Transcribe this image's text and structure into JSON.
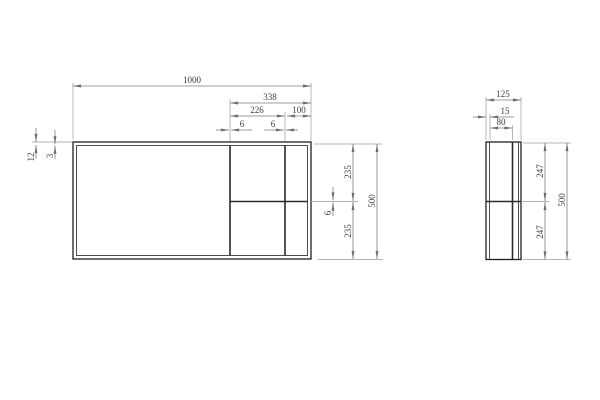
{
  "drawing": {
    "type": "technical-dimension-drawing",
    "views": {
      "front_view": "front elevation",
      "side_view": "side section"
    }
  },
  "dims": {
    "front": {
      "overall_width": "1000",
      "bay_width": "338",
      "bay_inner_width": "226",
      "right_bay_width": "100",
      "divider1_thickness": "6",
      "divider2_thickness": "6",
      "top_wall": "12",
      "top_wall_inner": "3",
      "upper_opening": "235",
      "shelf_thickness": "6",
      "lower_opening": "235",
      "overall_height": "500"
    },
    "side": {
      "depth": "125",
      "wall_thickness": "15",
      "inner_depth": "80",
      "upper_opening": "247",
      "lower_opening": "247",
      "overall_height": "500"
    }
  }
}
